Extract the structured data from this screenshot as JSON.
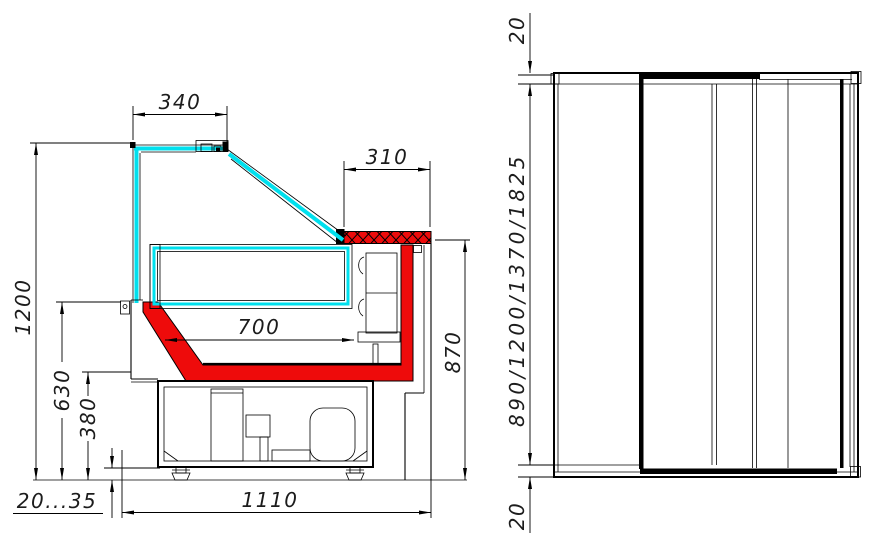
{
  "colors": {
    "glass_cyan": "#00e0ee",
    "accent_red": "#ee0b0b",
    "dim_text": "#1c1c1c",
    "line_black": "#000000",
    "background": "#ffffff"
  },
  "side_section_view": {
    "dims": {
      "canopy_width": "340",
      "worktop_depth": "310",
      "overall_height": "1200",
      "display_well_depth": "700",
      "worktop_height": "870",
      "front_panel_height": "630",
      "base_height": "380",
      "leg_adjust_range": "20...35",
      "overall_depth": "1110"
    }
  },
  "rear_elevation_view": {
    "dims": {
      "top_band": "20",
      "length_options": "890/1200/1370/1825",
      "bottom_band": "20"
    }
  }
}
